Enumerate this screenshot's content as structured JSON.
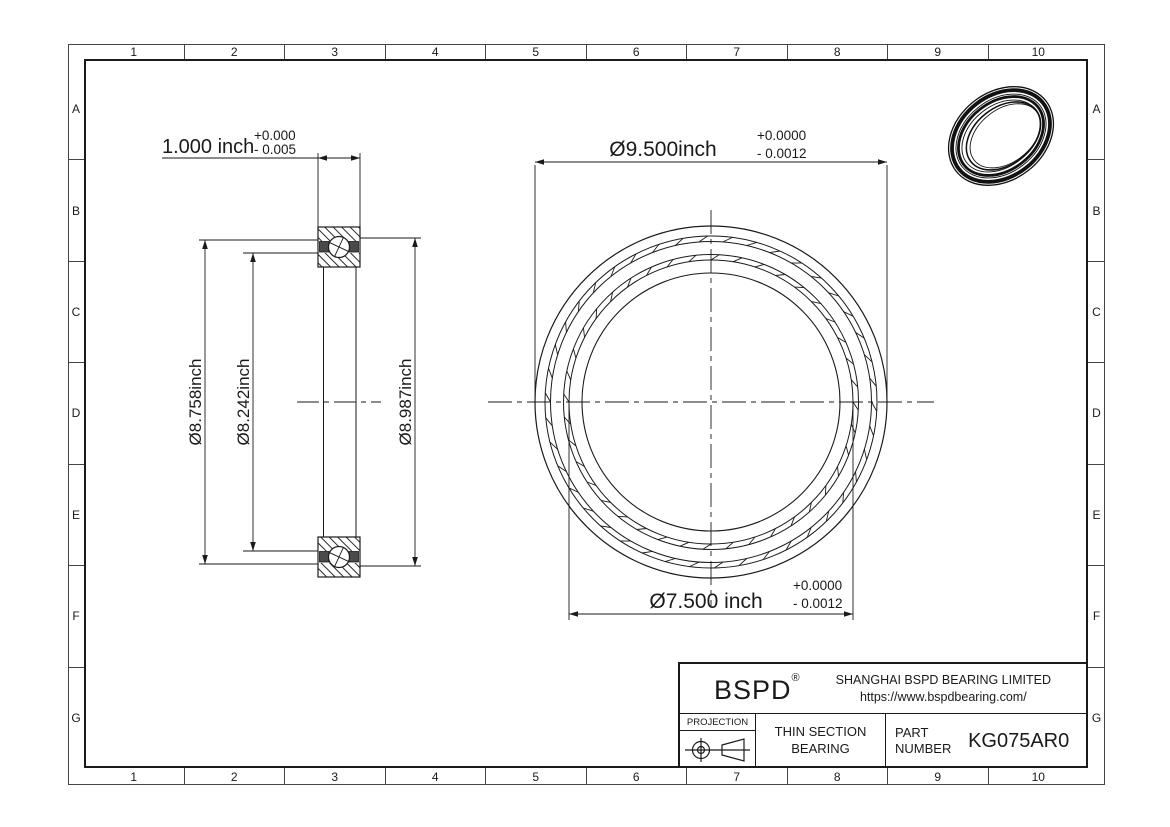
{
  "drawing": {
    "grid": {
      "columns": [
        "1",
        "2",
        "3",
        "4",
        "5",
        "6",
        "7",
        "8",
        "9",
        "10"
      ],
      "rows": [
        "A",
        "B",
        "C",
        "D",
        "E",
        "F",
        "G"
      ]
    },
    "side_view": {
      "width_dim": {
        "value": "1.000 inch",
        "tol_plus": "+0.000",
        "tol_minus": "- 0.005"
      },
      "outer_land_dim": "Ø8.758inch",
      "inner_land_dim": "Ø8.242inch",
      "race_dim": "Ø8.987inch"
    },
    "front_view": {
      "od_dim": {
        "value": "Ø9.500inch",
        "tol_plus": "+0.0000",
        "tol_minus": "- 0.0012"
      },
      "bore_dim": {
        "value": "Ø7.500 inch",
        "tol_plus": "+0.0000",
        "tol_minus": "- 0.0012"
      }
    },
    "title_block": {
      "logo": "BSPD",
      "logo_mark": "®",
      "company": "SHANGHAI BSPD BEARING LIMITED",
      "website": "https://www.bspdbearing.com/",
      "projection_label": "PROJECTION",
      "product_line1": "THIN SECTION",
      "product_line2": "BEARING",
      "part_label_line1": "PART",
      "part_label_line2": "NUMBER",
      "part_number": "KG075AR0"
    },
    "colors": {
      "line": "#1a1a1a",
      "seal_fill": "#4a4a4a"
    }
  }
}
